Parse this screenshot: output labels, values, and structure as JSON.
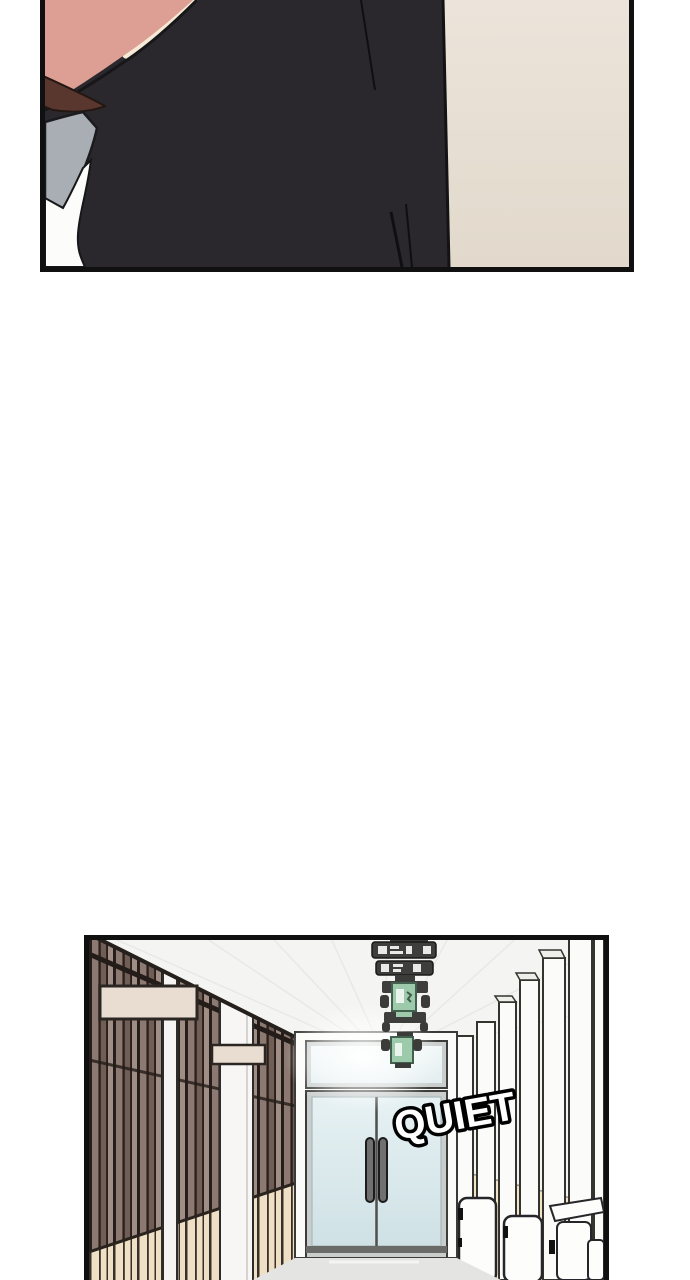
{
  "page": {
    "type": "webtoon comic page",
    "background": "#ffffff",
    "panel_count": 2
  },
  "top_panel": {
    "name": "closeup-panel",
    "description": "Close-up from behind of a person with brown hair wearing a dark jacket over a grey collar and white shirt, beige wall in the background",
    "colors": {
      "skin": "#dd9f94",
      "skin_highlight": "#f6ead6",
      "hair": "#59372f",
      "collar": "#a8aeb4",
      "shirt": "#fcfcfb",
      "jacket": "#2a282c",
      "wall": "#e6ddd2",
      "border": "#101010"
    }
  },
  "hallway_panel": {
    "name": "hallway-panel",
    "description": "School corridor with dark slatted classroom doors and blank nameplates on the left, glass double doors at the end of the hall, hanging ceiling signs with green exit lights, white pillars with beige wainscot on the right",
    "sfx_text": "QUIET",
    "nameplates": [
      "",
      ""
    ],
    "hanging_signs": [
      "ceiling-sign",
      "ceiling-sign",
      "exit-sign",
      "ceiling-sign",
      "exit-sign"
    ],
    "colors": {
      "ceiling": "#f4f4f2",
      "slat_wood": "#8c7a72",
      "slat_dark": "#2d2420",
      "nameplate": "#e9ddd1",
      "wainscot": "#f3e3c7",
      "glass": "#d8e8ec",
      "exit_green": "#9ccaab",
      "sign_dark": "#3e3e3c",
      "floor": "#e4e4e2",
      "sfx_fill": "#ffffff",
      "sfx_outline": "#000000",
      "border": "#101010"
    }
  }
}
